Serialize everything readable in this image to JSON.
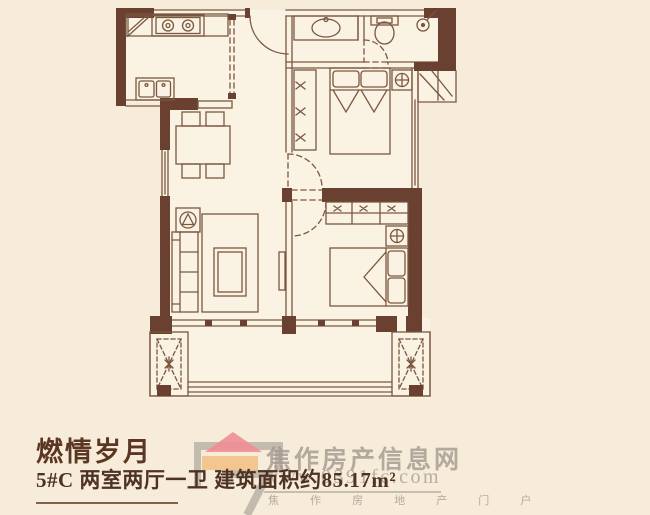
{
  "page": {
    "background": "#f7ecda"
  },
  "plan": {
    "wall_color": "#6a4030",
    "line_color": "#7b573f",
    "floor_color": "#faf3e4",
    "rooms": [
      "kitchen",
      "bathroom",
      "bedroom-1",
      "bedroom-2",
      "living-room",
      "dining-area",
      "hallway",
      "balcony"
    ],
    "fixtures": [
      "corner-shelf",
      "stove",
      "kitchen-sink",
      "sliding-door",
      "entrance-door",
      "washbasin",
      "toilet",
      "shower-head",
      "wardrobe",
      "double-bed",
      "pillows",
      "nightstand",
      "dining-table",
      "dining-chairs",
      "sofa",
      "side-table-plant",
      "rug",
      "coffee-table",
      "tv",
      "ac-platform",
      "balcony-planter",
      "balcony-railing"
    ]
  },
  "footer": {
    "title": "燃情岁月",
    "subtitle": "5#C 两室两厅一卫 建筑面积约85.17m²",
    "title_color": "#5b3723",
    "text_color": "#4e3222"
  },
  "watermark": {
    "site_name": "焦作房产信息网",
    "site_url": "www.0391fc.com",
    "tagline": "焦 作 房 地 产 门 户",
    "text_color": "#a39a8d",
    "logo": {
      "roof_color": "#ef8e95",
      "body_color": "#f2c289",
      "frame_color": "#9a938c"
    }
  }
}
